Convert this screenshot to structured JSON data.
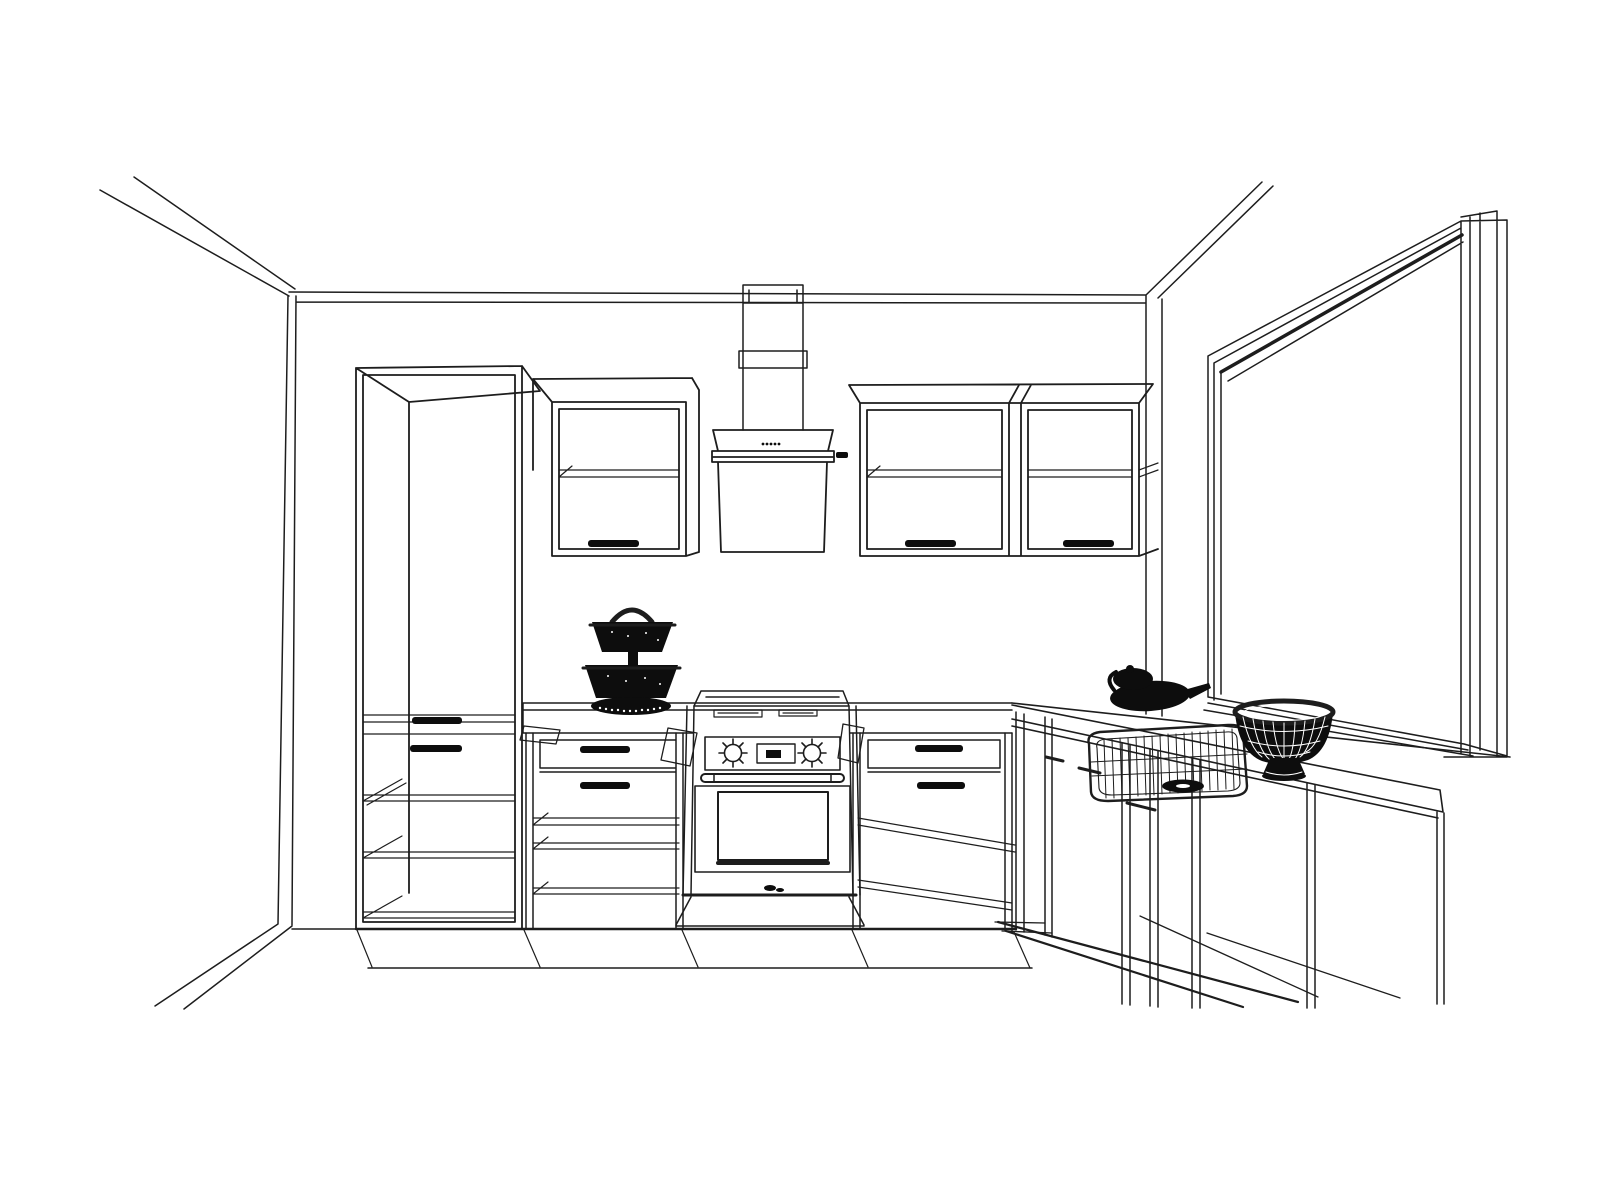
{
  "canvas": {
    "width": 1600,
    "height": 1200,
    "background": "#ffffff"
  },
  "style": {
    "line_color": "#1d1d1d",
    "heavy_line_color": "#000000",
    "solid_fill_color": "#0d0d0d",
    "highlight_color": "#ffffff"
  },
  "scene": {
    "kind": "interior-design wireframe sketch",
    "room": "kitchen",
    "view": "perspective with hidden lines visible",
    "walls": "left wall, back wall and right wall with corner at right of cabinets",
    "floor": "bare, indicated by perspective lines only"
  },
  "objects": [
    {
      "name": "tall-cabinet",
      "description": "tall pantry cabinet with 2 drawers and 3 open shelves",
      "bbox": [
        356,
        366,
        540,
        968
      ]
    },
    {
      "name": "wall-cabinet-left",
      "description": "wall cabinet with internal shelf and handle",
      "bbox": [
        533,
        378,
        702,
        556
      ]
    },
    {
      "name": "range-hood",
      "description": "chimney hood with duct, 5 control dots and glass front",
      "bbox": [
        712,
        285,
        834,
        556
      ]
    },
    {
      "name": "wall-cabinet-right-pair",
      "description": "double wall cabinet with divider, shelves and 2 handles",
      "bbox": [
        849,
        384,
        1153,
        556
      ]
    },
    {
      "name": "countertop-left-run",
      "description": "straight counter between tall cabinet and corner",
      "bbox": [
        523,
        703,
        1012,
        733
      ]
    },
    {
      "name": "range-stove",
      "description": "freestanding cooker: cooktop, 2 knobs, display, oven door with window and handle",
      "bbox": [
        676,
        690,
        864,
        929
      ]
    },
    {
      "name": "base-cabinet-left",
      "description": "base cabinet with 2 drawers and open shelves",
      "bbox": [
        523,
        733,
        693,
        929
      ]
    },
    {
      "name": "base-cabinet-right",
      "description": "base cabinet with 2 drawers and receding shelves",
      "bbox": [
        850,
        733,
        1016,
        932
      ]
    },
    {
      "name": "corner-right-run",
      "description": "L-return counter run receding to viewer with doors and end panel",
      "bbox": [
        1012,
        694,
        1444,
        1008
      ]
    },
    {
      "name": "sink-basket",
      "description": "wireframe wire-mesh sink basin with drain",
      "bbox": [
        1086,
        724,
        1247,
        801
      ]
    },
    {
      "name": "window",
      "description": "large window recessed in right wall with deep frame and sill",
      "bbox": [
        1204,
        211,
        1510,
        763
      ]
    },
    {
      "name": "two-tier-basket",
      "description": "black silhouette two-tier fruit basket on counter",
      "bbox": [
        585,
        600,
        678,
        715
      ]
    },
    {
      "name": "kettle",
      "description": "black teapot / kettle silhouette near sink corner",
      "bbox": [
        1104,
        663,
        1211,
        712
      ]
    },
    {
      "name": "wire-fruit-bowl",
      "description": "black lattice fruit bowl on footed base at right counter",
      "bbox": [
        1235,
        701,
        1333,
        781
      ]
    }
  ],
  "counts": {
    "tall_cabinets": 1,
    "wall_cabinet_doors": 3,
    "wall_cabinet_handles": 3,
    "base_drawer_handles": 6,
    "hood_control_dots": 5,
    "stove_knobs": 2,
    "stove_display": 1,
    "open_shelves_tall_cabinet": 3,
    "black_accessories": 3
  }
}
